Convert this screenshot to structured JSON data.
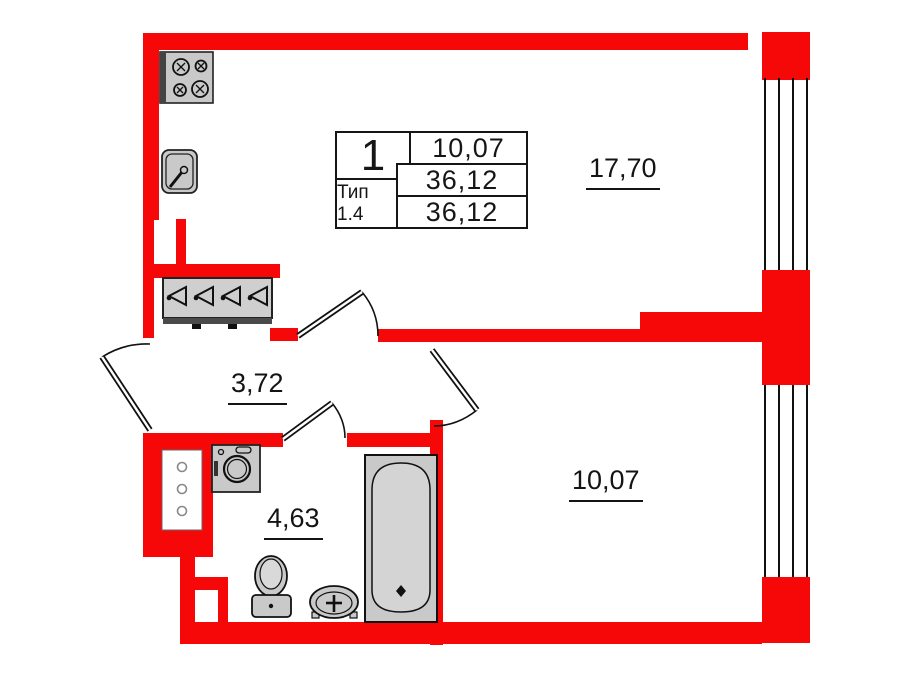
{
  "plan_card": {
    "rooms_count": "1",
    "type_label": "Тип 1.4",
    "area_living": "10,07",
    "area_total": "36,12",
    "area_total_reduced": "36,12"
  },
  "room_labels": {
    "kitchen_living": "17,70",
    "bedroom": "10,07",
    "hallway": "3,72",
    "bathroom": "4,63"
  },
  "colors": {
    "wall": "#f70808",
    "fixture_fill": "#c9c9c9",
    "line": "#111111"
  }
}
